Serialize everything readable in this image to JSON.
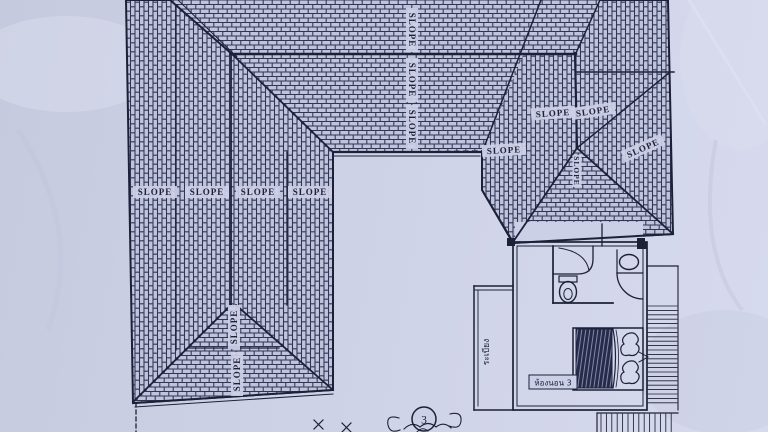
{
  "drawing": {
    "slope_label_text": "SLOPE",
    "room_labels": {
      "terrace": "ระเบียง",
      "bedroom": "ห้องนอน 3"
    },
    "grid_bubble_number": "3",
    "slope_instances": [
      {
        "x": 155,
        "y": 192,
        "r": 0
      },
      {
        "x": 207,
        "y": 192,
        "r": 0
      },
      {
        "x": 258,
        "y": 192,
        "r": 0
      },
      {
        "x": 310,
        "y": 192,
        "r": 0
      },
      {
        "x": 412,
        "y": 30,
        "r": 90
      },
      {
        "x": 412,
        "y": 80,
        "r": 90
      },
      {
        "x": 412,
        "y": 127,
        "r": 90
      },
      {
        "x": 234,
        "y": 327,
        "r": -90
      },
      {
        "x": 237,
        "y": 374,
        "r": -90
      },
      {
        "x": 553,
        "y": 113,
        "r": -4
      },
      {
        "x": 593,
        "y": 111,
        "r": -8
      },
      {
        "x": 504,
        "y": 150,
        "r": -3
      },
      {
        "x": 643,
        "y": 148,
        "r": -24
      },
      {
        "x": 577,
        "y": 171,
        "r": 90,
        "small": true
      }
    ]
  },
  "colors": {
    "paper": "#ccd0e6",
    "ink": "#1c2138",
    "hatch_line": "#2f3557",
    "hatch_bg": "#c0c4da",
    "blanket": "#262b4a"
  }
}
